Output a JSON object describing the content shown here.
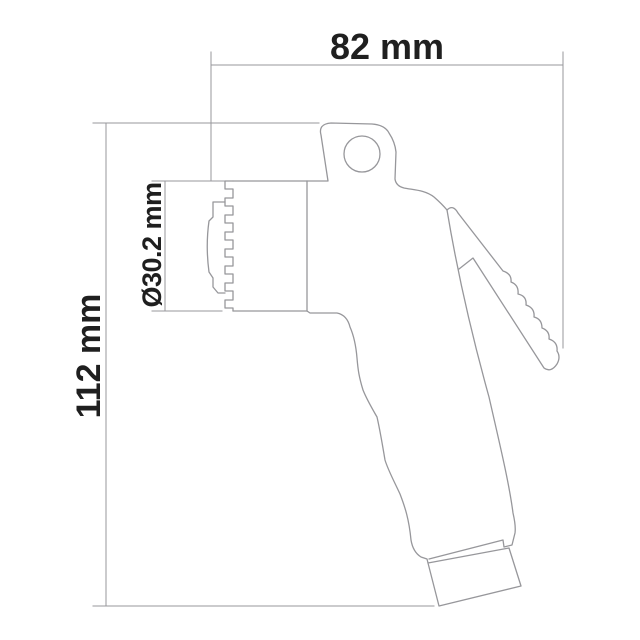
{
  "drawing": {
    "dimension_width_label": "82 mm",
    "dimension_height_label": "112 mm",
    "dimension_diameter_label": "Ø30.2 mm"
  },
  "colors": {
    "line": "#97979b",
    "dimension_line": "#97979b",
    "text": "#1f1f1f",
    "background": "#ffffff"
  }
}
